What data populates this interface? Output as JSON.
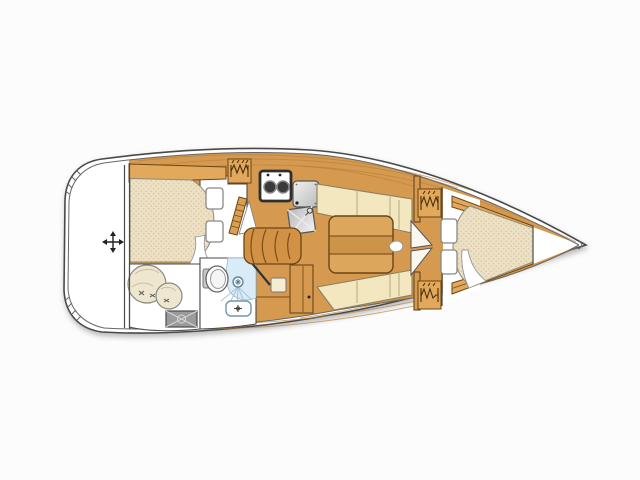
{
  "image": {
    "kind": "sailboat interior layout floor plan, top-down view",
    "orientation": "bow pointing right, rounded transom at left",
    "background": "#fcfcfc"
  },
  "palette": {
    "outline": "#4a4a4a",
    "outline_soft": "#666666",
    "wood": "#d59a50",
    "wood_light": "#e2a85c",
    "wood_edge": "#6b4516",
    "wood_grain": "#b5803a",
    "mattress": "#ece0c5",
    "mattress_dot": "#dac8a1",
    "mattress_edge": "#8a8a7a",
    "cushion": "#f2e7be",
    "cushion_edge": "#8a8060",
    "cushion_line": "#b5a97e",
    "white": "#ffffff",
    "page_bg": "#fcfcfc",
    "shower": "#d9ebf6",
    "shower_line": "#a9c6da",
    "shower_dark": "#55788e",
    "metal_light": "#f2f2f2",
    "metal_dark": "#b9b9b9",
    "stove_frame": "#2e2e2e",
    "burner": "#3a3a3a",
    "hatch_gray": "#9b9b9b",
    "hatch_line": "#d5d5d5",
    "icon_dark": "#222222",
    "glyph_brown": "#4a2f08",
    "table_top": "#dca75c",
    "table_mid": "#cc9349"
  },
  "regions": [
    {
      "name": "cockpit",
      "items": [
        "position-crosshair-icon"
      ]
    },
    {
      "name": "aft-cabin",
      "items": [
        "double-berth-mattress",
        "folded-sheet",
        "step-seat",
        "step-seat",
        "side-shelf"
      ]
    },
    {
      "name": "stowage-locker",
      "items": [
        "sail-bag-large",
        "sail-bag-small",
        "gray-hatch-with-cross"
      ]
    },
    {
      "name": "galley",
      "items": [
        "hanging-locker",
        "two-burner-stove",
        "icebox-lid",
        "sink-with-faucet",
        "louvered-door"
      ]
    },
    {
      "name": "companionway",
      "items": [
        "curved-steps"
      ]
    },
    {
      "name": "head",
      "items": [
        "toilet",
        "shower-pan",
        "shower-head-spray",
        "washbasin",
        "open-door"
      ]
    },
    {
      "name": "nav-area",
      "items": [
        "cabinet",
        "seat-cushion"
      ]
    },
    {
      "name": "saloon",
      "items": [
        "port-settee",
        "starboard-settee",
        "folding-table",
        "table-latch"
      ]
    },
    {
      "name": "forward-bulkhead",
      "items": [
        "hanging-locker-port",
        "hanging-locker-starboard",
        "double-door-leaves"
      ]
    },
    {
      "name": "forward-cabin",
      "items": [
        "v-berth-mattress",
        "folded-sheet",
        "step-seat",
        "step-seat",
        "side-rail-port",
        "side-rail-starboard"
      ]
    },
    {
      "name": "bow",
      "items": [
        "anchor-locker"
      ]
    }
  ]
}
